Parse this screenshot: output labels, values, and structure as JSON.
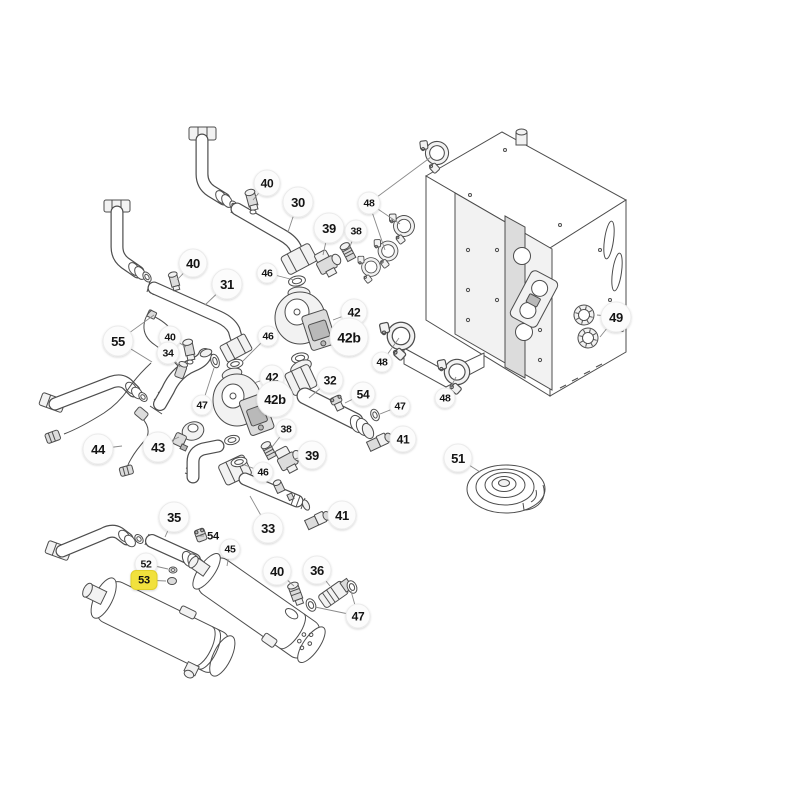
{
  "page": {
    "background": "#ffffff",
    "type": "exploded-parts-diagram",
    "subject": "boiler heating unit spare parts schematic"
  },
  "diagram": {
    "highlighted_callout": "53",
    "colors": {
      "line": "#4d4d4d",
      "leader": "#8a8a8a",
      "callout_fill": "#fcfcfc",
      "callout_stroke": "#ebebeb",
      "callout_text": "#141414",
      "highlight_fill": "#f1e13c",
      "highlight_stroke": "#e0cf2c",
      "highlight_text": "#111111"
    },
    "part_numbers_visible": [
      "30",
      "31",
      "32",
      "33",
      "34",
      "35",
      "36",
      "38",
      "39",
      "40",
      "41",
      "42",
      "42b",
      "43",
      "44",
      "45",
      "46",
      "47",
      "48",
      "49",
      "51",
      "52",
      "53",
      "54",
      "55"
    ],
    "callouts": [
      {
        "id": "40-1",
        "label": "40",
        "x": 267,
        "y": 183,
        "r": 13,
        "shape": "circle",
        "leaders": [
          [
            253,
            200
          ]
        ]
      },
      {
        "id": "30",
        "label": "30",
        "x": 298,
        "y": 202,
        "r": 15,
        "shape": "circle",
        "leaders": [
          [
            288,
            232
          ]
        ]
      },
      {
        "id": "39-1",
        "label": "39",
        "x": 329,
        "y": 228,
        "r": 15,
        "shape": "circle",
        "leaders": [
          [
            323,
            255
          ]
        ]
      },
      {
        "id": "38-1",
        "label": "38",
        "x": 356,
        "y": 231,
        "r": 11,
        "shape": "circle",
        "leaders": [
          [
            349,
            249
          ]
        ]
      },
      {
        "id": "48-1",
        "label": "48",
        "x": 369,
        "y": 203,
        "r": 11,
        "shape": "circle",
        "leaders": [
          [
            431,
            157
          ],
          [
            400,
            224
          ],
          [
            385,
            250
          ]
        ]
      },
      {
        "id": "46-1",
        "label": "46",
        "x": 267,
        "y": 273,
        "r": 10,
        "shape": "circle",
        "leaders": [
          [
            294,
            280
          ]
        ]
      },
      {
        "id": "42-1",
        "label": "42",
        "x": 354,
        "y": 312,
        "r": 13,
        "shape": "circle",
        "leaders": [
          [
            333,
            320
          ]
        ]
      },
      {
        "id": "42b-1",
        "label": "42b",
        "x": 349,
        "y": 337,
        "r": 19,
        "shape": "circle",
        "leaders": []
      },
      {
        "id": "31",
        "label": "31",
        "x": 227,
        "y": 284,
        "r": 15,
        "shape": "circle",
        "leaders": [
          [
            205,
            305
          ]
        ]
      },
      {
        "id": "40-2",
        "label": "40",
        "x": 193,
        "y": 263,
        "r": 14,
        "shape": "circle",
        "leaders": [
          [
            177,
            280
          ]
        ]
      },
      {
        "id": "55",
        "label": "55",
        "x": 118,
        "y": 341,
        "r": 15,
        "shape": "circle",
        "leaders": [
          [
            154,
            315
          ],
          [
            152,
            362
          ]
        ]
      },
      {
        "id": "40-3",
        "label": "40",
        "x": 170,
        "y": 337,
        "r": 11,
        "shape": "circle",
        "leaders": [
          [
            186,
            347
          ]
        ]
      },
      {
        "id": "34",
        "label": "34",
        "x": 168,
        "y": 353,
        "r": 11,
        "shape": "circle",
        "leaders": [
          [
            180,
            367
          ]
        ]
      },
      {
        "id": "46-2",
        "label": "46",
        "x": 268,
        "y": 336,
        "r": 10,
        "shape": "circle",
        "leaders": [
          [
            243,
            361
          ]
        ]
      },
      {
        "id": "42-2",
        "label": "42",
        "x": 272,
        "y": 377,
        "r": 12,
        "shape": "circle",
        "leaders": [
          [
            254,
            383
          ]
        ]
      },
      {
        "id": "42b-2",
        "label": "42b",
        "x": 275,
        "y": 399,
        "r": 18,
        "shape": "circle",
        "leaders": []
      },
      {
        "id": "32",
        "label": "32",
        "x": 330,
        "y": 380,
        "r": 13,
        "shape": "circle",
        "leaders": [
          [
            309,
            398
          ]
        ]
      },
      {
        "id": "54-1",
        "label": "54",
        "x": 363,
        "y": 394,
        "r": 12,
        "shape": "circle",
        "leaders": [
          [
            345,
            403
          ]
        ]
      },
      {
        "id": "47-1",
        "label": "47",
        "x": 400,
        "y": 406,
        "r": 10,
        "shape": "circle",
        "leaders": [
          [
            380,
            414
          ]
        ]
      },
      {
        "id": "41-1",
        "label": "41",
        "x": 403,
        "y": 439,
        "r": 13,
        "shape": "circle",
        "leaders": [
          [
            388,
            442
          ]
        ]
      },
      {
        "id": "48-2",
        "label": "48",
        "x": 382,
        "y": 362,
        "r": 10,
        "shape": "circle",
        "leaders": [
          [
            399,
            338
          ]
        ]
      },
      {
        "id": "48-3",
        "label": "48",
        "x": 445,
        "y": 398,
        "r": 10,
        "shape": "circle",
        "leaders": [
          [
            456,
            377
          ]
        ]
      },
      {
        "id": "49",
        "label": "49",
        "x": 616,
        "y": 317,
        "r": 15,
        "shape": "circle",
        "leaders": [
          [
            597,
            315
          ],
          [
            600,
            337
          ]
        ]
      },
      {
        "id": "47-2",
        "label": "47",
        "x": 202,
        "y": 405,
        "r": 10,
        "shape": "circle",
        "leaders": [
          [
            214,
            368
          ]
        ]
      },
      {
        "id": "43",
        "label": "43",
        "x": 158,
        "y": 447,
        "r": 15,
        "shape": "circle",
        "leaders": [
          [
            179,
            437
          ]
        ]
      },
      {
        "id": "44",
        "label": "44",
        "x": 98,
        "y": 449,
        "r": 15,
        "shape": "circle",
        "leaders": [
          [
            122,
            446
          ]
        ]
      },
      {
        "id": "38-2",
        "label": "38",
        "x": 286,
        "y": 429,
        "r": 10,
        "shape": "circle",
        "leaders": [
          [
            272,
            447
          ]
        ]
      },
      {
        "id": "39-2",
        "label": "39",
        "x": 312,
        "y": 455,
        "r": 14,
        "shape": "circle",
        "leaders": [
          [
            294,
            459
          ]
        ]
      },
      {
        "id": "46-3",
        "label": "46",
        "x": 263,
        "y": 472,
        "r": 10,
        "shape": "circle",
        "leaders": [
          [
            242,
            464
          ]
        ]
      },
      {
        "id": "33",
        "label": "33",
        "x": 268,
        "y": 528,
        "r": 15,
        "shape": "circle",
        "leaders": [
          [
            250,
            496
          ]
        ]
      },
      {
        "id": "41-2",
        "label": "41",
        "x": 342,
        "y": 515,
        "r": 14,
        "shape": "circle",
        "leaders": [
          [
            327,
            520
          ]
        ]
      },
      {
        "id": "51",
        "label": "51",
        "x": 458,
        "y": 458,
        "r": 14,
        "shape": "circle",
        "leaders": [
          [
            480,
            472
          ]
        ]
      },
      {
        "id": "35",
        "label": "35",
        "x": 174,
        "y": 517,
        "r": 15,
        "shape": "circle",
        "leaders": [
          [
            165,
            537
          ]
        ]
      },
      {
        "id": "54-2",
        "label": "54",
        "x": 213,
        "y": 536,
        "shape": "text",
        "leaders": [
          [
            199,
            536
          ]
        ]
      },
      {
        "id": "45",
        "label": "45",
        "x": 230,
        "y": 549,
        "r": 10,
        "shape": "circle",
        "leaders": [
          [
            227,
            566
          ]
        ]
      },
      {
        "id": "52",
        "label": "52",
        "x": 146,
        "y": 564,
        "r": 11,
        "shape": "circle",
        "leaders": [
          [
            168,
            569
          ]
        ]
      },
      {
        "id": "53",
        "label": "53",
        "x": 144,
        "y": 580,
        "w": 26,
        "h": 19,
        "shape": "badge",
        "leaders": [
          [
            166,
            581
          ]
        ]
      },
      {
        "id": "40-4",
        "label": "40",
        "x": 277,
        "y": 571,
        "r": 14,
        "shape": "circle",
        "leaders": [
          [
            294,
            586
          ]
        ]
      },
      {
        "id": "36",
        "label": "36",
        "x": 317,
        "y": 570,
        "r": 14,
        "shape": "circle",
        "leaders": [
          [
            330,
            586
          ]
        ]
      },
      {
        "id": "47-3",
        "label": "47",
        "x": 358,
        "y": 616,
        "r": 12,
        "shape": "circle",
        "leaders": [
          [
            315,
            607
          ],
          [
            351,
            591
          ]
        ]
      }
    ]
  }
}
